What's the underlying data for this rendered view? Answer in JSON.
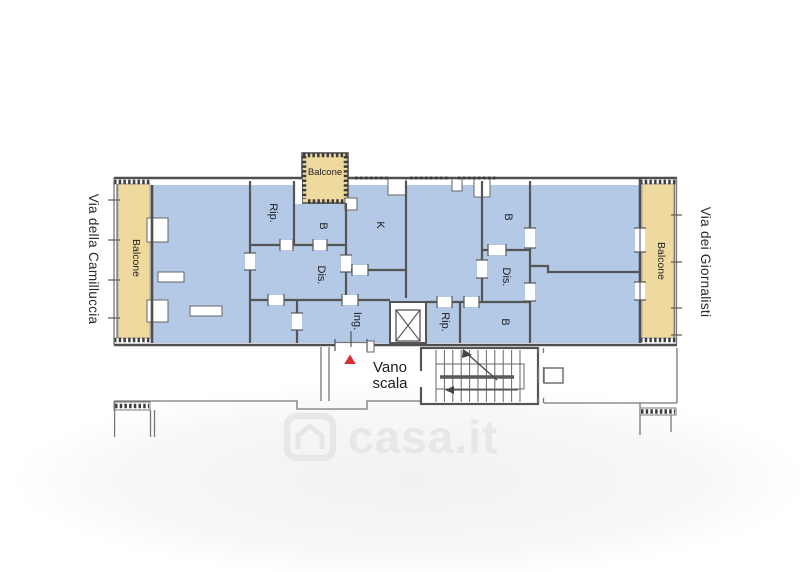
{
  "floorplan": {
    "streets": {
      "left": "Via della Camilluccia",
      "right": "Via dei Giornalisti"
    },
    "balconies": {
      "left_label": "Balcone",
      "top_label": "Balcone",
      "right_label": "Balcone"
    },
    "rooms": {
      "storage_top": "Rip.",
      "bath_top": "B",
      "kitchen": "K",
      "bath_mid": "B",
      "hall_left": "Dis.",
      "hall_right": "Dis.",
      "entry": "Ing.",
      "storage_bottom": "Rip.",
      "bath_bottom": "B"
    },
    "stairwell": {
      "line1": "Vano",
      "line2": "scala"
    },
    "colors": {
      "room_fill": "#b3c9e6",
      "balcony_fill": "#eeda9f",
      "wall": "#4f4f4f",
      "thin_line": "#777777",
      "entrance_marker_red": "#d62f38",
      "watermark_gray": "#e7e7e7"
    }
  },
  "watermark": {
    "text": "casa.it"
  }
}
